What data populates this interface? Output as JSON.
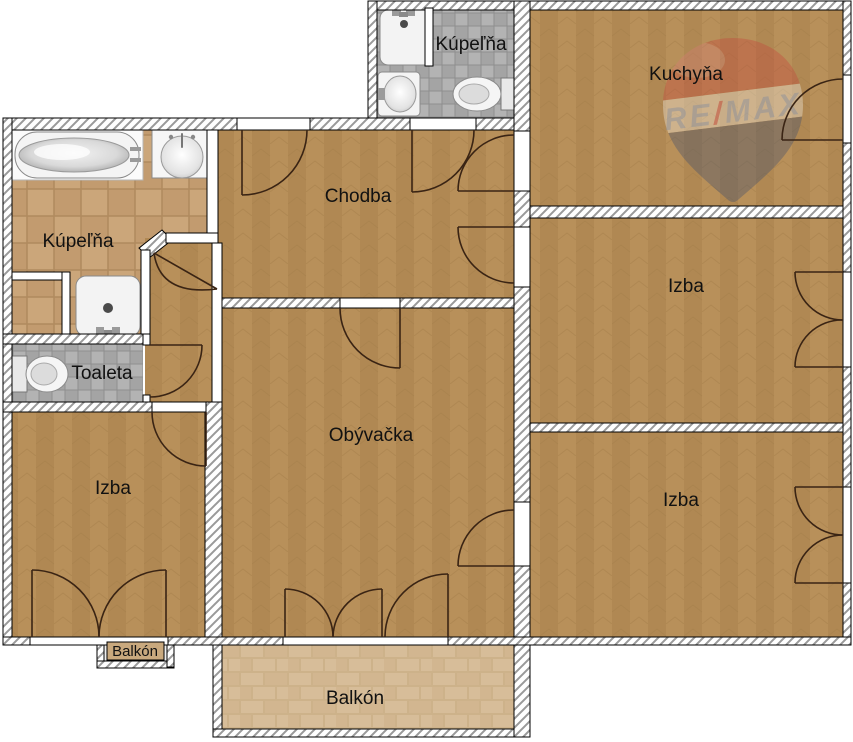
{
  "plan": {
    "title": "Floor plan",
    "rooms": {
      "bathroom_main": "Kúpeľňa",
      "bathroom_top": "Kúpeľňa",
      "kitchen": "Kuchyňa",
      "hallway": "Chodba",
      "room_right_top": "Izba",
      "room_right_bottom": "Izba",
      "living_room": "Obývačka",
      "toilet": "Toaleta",
      "room_left": "Izba",
      "balcony_large": "Balkón",
      "balcony_small": "Balkón"
    },
    "watermark": {
      "brand": "RE/MAX",
      "re": "RE",
      "slash": "/",
      "max": "MAX"
    },
    "colors": {
      "floor_wood": "#b8905a",
      "floor_tile_tan": "#cba67a",
      "floor_tile_gray": "#adadad",
      "floor_brick": "#d5ba95",
      "wall_fill": "#ffffff",
      "outline": "#000000",
      "door_arc": "#3a2414",
      "remax_red": "#c5443a",
      "remax_blue": "#3a4a6e"
    }
  }
}
